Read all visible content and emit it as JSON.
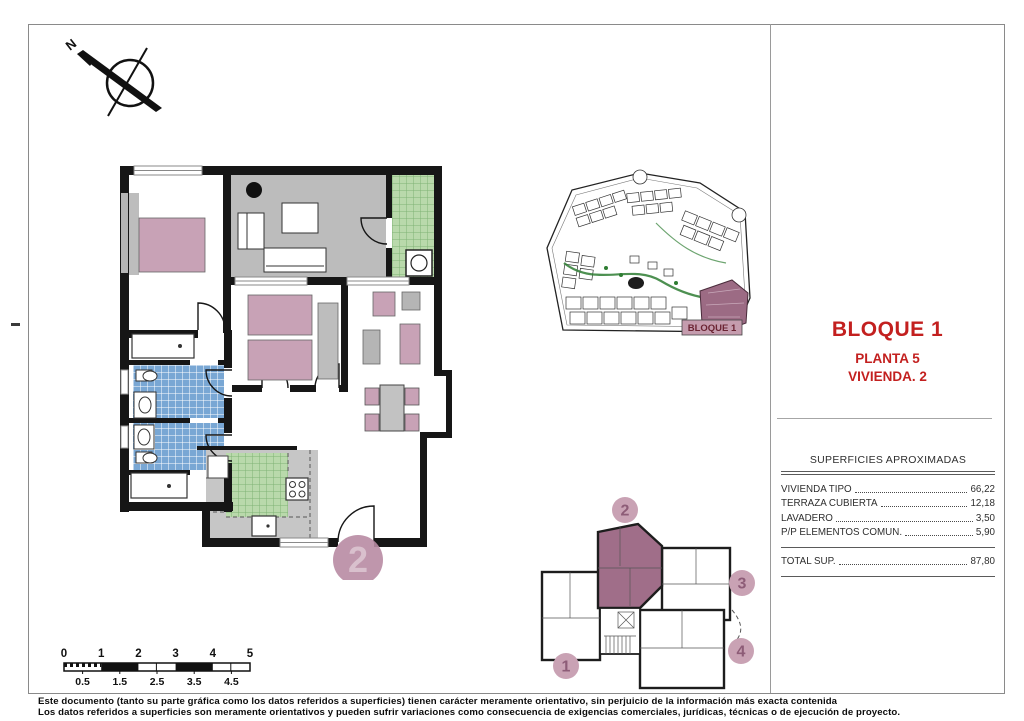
{
  "title_block": {
    "line1": "BLOQUE 1",
    "line2": "PLANTA 5",
    "line3": "VIVIENDA. 2"
  },
  "areas_table": {
    "header": "SUPERFICIES APROXIMADAS",
    "rows": [
      {
        "label": "VIVIENDA TIPO",
        "value": "66,22"
      },
      {
        "label": "TERRAZA CUBIERTA",
        "value": "12,18"
      },
      {
        "label": "LAVADERO",
        "value": "3,50"
      },
      {
        "label": "P/P ELEMENTOS COMUN.",
        "value": "5,90"
      }
    ],
    "total": {
      "label": "TOTAL SUP.",
      "value": "87,80"
    }
  },
  "site_plan": {
    "label": "BLOQUE 1"
  },
  "key_plan": {
    "unit_labels": [
      "1",
      "2",
      "3",
      "4"
    ],
    "highlighted_unit": "2"
  },
  "floor_plan": {
    "unit_badge": "2"
  },
  "compass": {
    "north_label": "N"
  },
  "scale_bar": {
    "major_labels": [
      "0",
      "1",
      "2",
      "3",
      "4",
      "5"
    ],
    "minor_labels": [
      "0.5",
      "1.5",
      "2.5",
      "3.5",
      "4.5"
    ]
  },
  "footer": {
    "line1": "Este documento (tanto su parte gráfica como los datos referidos a superficies) tienen carácter meramente orientativo, sin perjuicio de la información más exacta contenida",
    "line2": "Los datos referidos a superficies son meramente orientativos y pueden sufrir variaciones como consecuencia de exigencias comerciales, jurídicas, técnicas o de ejecución de proyecto."
  },
  "colors": {
    "accent": "#c3201f",
    "mauve_badge": "#c9a2b4",
    "mauve_dark": "#9c6b84",
    "furniture_pink": "#c8a2b6",
    "terrace_gray": "#bcbcbc",
    "tile_green": "#b9d9ab",
    "tile_blue": "#79a7d4"
  }
}
